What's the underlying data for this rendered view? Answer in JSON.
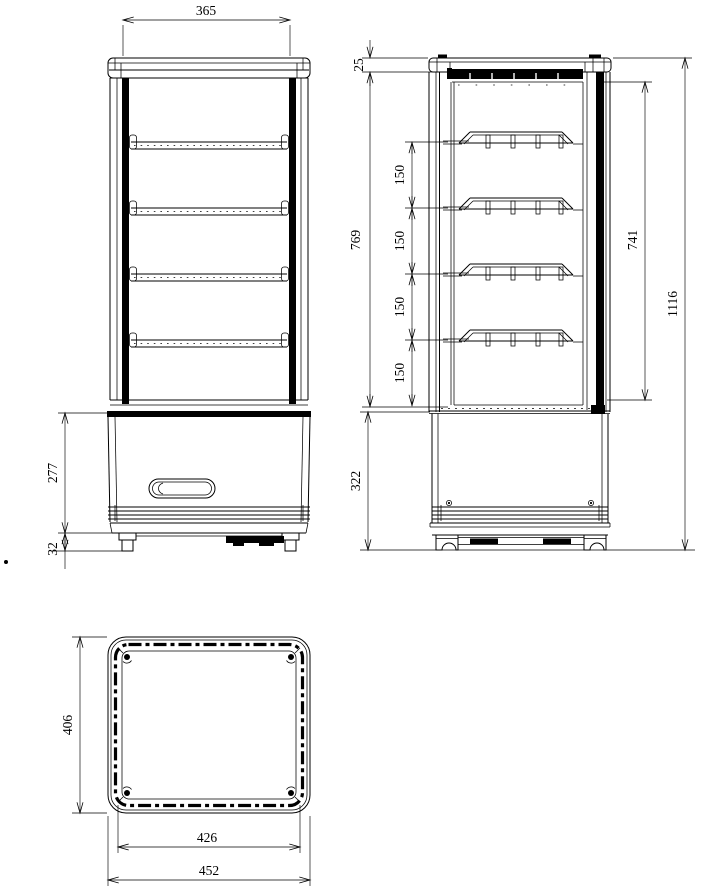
{
  "drawing": {
    "background_color": "#ffffff",
    "line_color": "#000000",
    "views": {
      "front": {
        "label": "front-view",
        "dims": {
          "top_width": "365",
          "base_height": "277",
          "foot_height": "32"
        }
      },
      "side": {
        "label": "side-view",
        "dims": {
          "cap_height": "25",
          "interior_height": "769",
          "shelf_gap_1": "150",
          "shelf_gap_2": "150",
          "shelf_gap_3": "150",
          "shelf_gap_4": "150",
          "door_height": "741",
          "total_height": "1116",
          "base_height": "322"
        }
      },
      "top": {
        "label": "top-view",
        "dims": {
          "depth": "406",
          "inner_width": "426",
          "outer_width": "452"
        }
      }
    }
  }
}
